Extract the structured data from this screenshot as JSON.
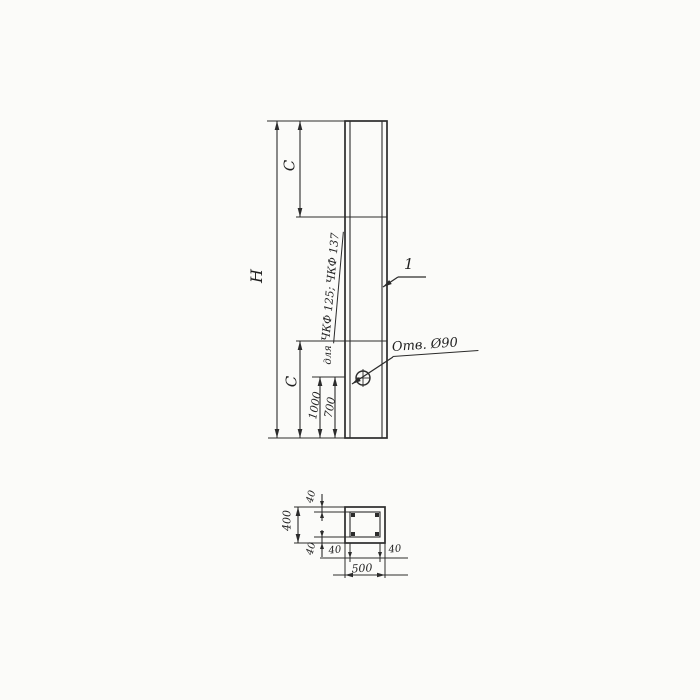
{
  "drawing": {
    "elevation": {
      "dim_h": "H",
      "dim_c_top": "C",
      "dim_c_bottom": "C",
      "dim_1000": "1000",
      "dim_700": "700",
      "note_for": "для",
      "note_marks": "ЧКФ 125; ЧКФ 137",
      "hole_label": "Отв. Ø90",
      "part_ref": "1"
    },
    "section": {
      "dim_width": "500",
      "dim_height": "400",
      "wall_top": "40",
      "wall_bottom": "40",
      "wall_left": "40",
      "wall_right": "40"
    },
    "colors": {
      "line": "#2c2c2c",
      "paper": "#fbfbf9"
    }
  }
}
